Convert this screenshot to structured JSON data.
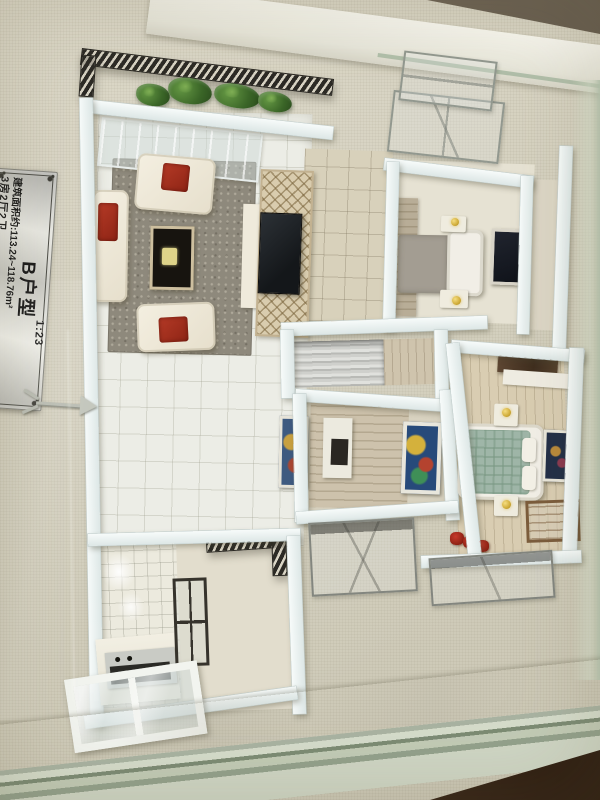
{
  "plaque": {
    "title": "B户型",
    "scale": "1:23",
    "layout_line": "3房2厅2卫",
    "area_line": "建筑面积约:113.24~118.76m²"
  },
  "icons": {
    "north_arrow": "➤"
  },
  "colors": {
    "base_board": "#d7d3c1",
    "model_wall": "#e8f0ef",
    "railing_dark": "#2c2a25",
    "plant_green": "#3a6527",
    "sofa_cream": "#f0ebdc",
    "cushion_red": "#a93222",
    "rug_gray": "#8e897c",
    "coffee_table_dark": "#17140f",
    "lattice_tan": "#d9ccae",
    "bed_teal_plaid": "#9fb6a8",
    "bed_gray": "#a39d92",
    "lamp_gold": "#cda833",
    "wardrobe_wood": "#4f3a2b",
    "shelf_white": "#f2f1e7",
    "marble_counter": "#f2efe3",
    "glass_green": "#9fb099",
    "wood_counter_dark": "#4e3827",
    "plaque_silver": "#d9d9d3"
  }
}
